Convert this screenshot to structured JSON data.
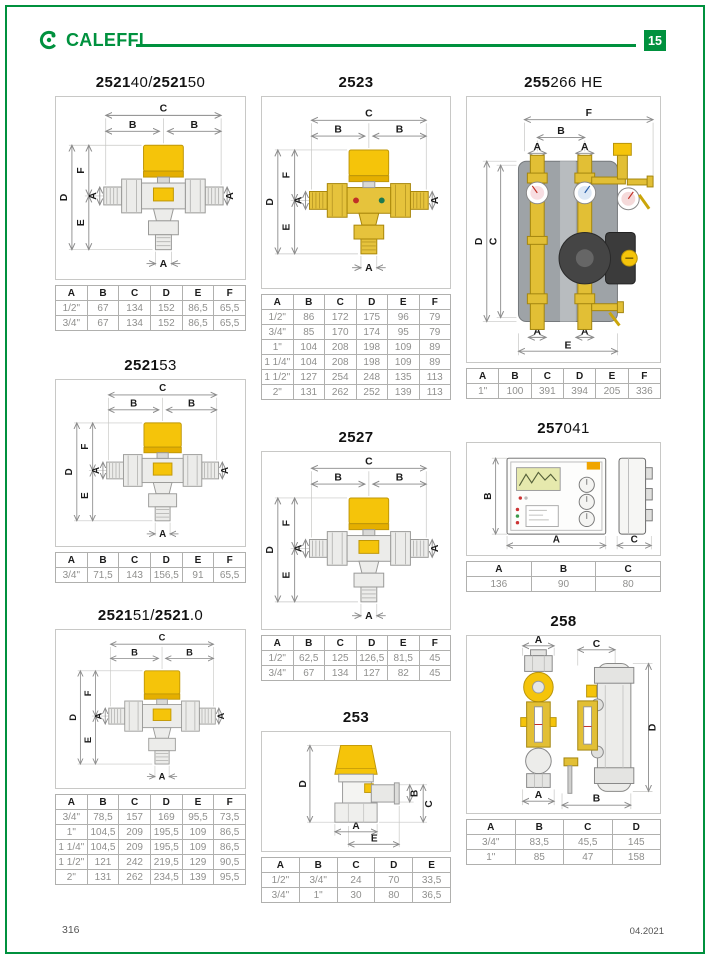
{
  "page": {
    "brand": "CALEFFI",
    "badge": "15",
    "footer_left": "316",
    "footer_right": "04.2021",
    "accent_green": "#00913e"
  },
  "dims": {
    "A": "A",
    "B": "B",
    "C": "C",
    "D": "D",
    "E": "E",
    "F": "F"
  },
  "sections": {
    "v252140": {
      "title": [
        {
          "t": "2521",
          "b": true
        },
        {
          "t": "40/",
          "b": false
        },
        {
          "t": "2521",
          "b": true
        },
        {
          "t": "50",
          "b": false
        }
      ],
      "table": {
        "headers": [
          "A",
          "B",
          "C",
          "D",
          "E",
          "F"
        ],
        "rows": [
          [
            "1/2\"",
            "67",
            "134",
            "152",
            "86,5",
            "65,5"
          ],
          [
            "3/4\"",
            "67",
            "134",
            "152",
            "86,5",
            "65,5"
          ]
        ]
      }
    },
    "v2523": {
      "title": [
        {
          "t": "2523",
          "b": true
        }
      ],
      "table": {
        "headers": [
          "A",
          "B",
          "C",
          "D",
          "E",
          "F"
        ],
        "rows": [
          [
            "1/2\"",
            "86",
            "172",
            "175",
            "96",
            "79"
          ],
          [
            "3/4\"",
            "85",
            "170",
            "174",
            "95",
            "79"
          ],
          [
            "1\"",
            "104",
            "208",
            "198",
            "109",
            "89"
          ],
          [
            "1 1/4\"",
            "104",
            "208",
            "198",
            "109",
            "89"
          ],
          [
            "1 1/2\"",
            "127",
            "254",
            "248",
            "135",
            "113"
          ],
          [
            "2\"",
            "131",
            "262",
            "252",
            "139",
            "113"
          ]
        ]
      }
    },
    "v255266": {
      "title": [
        {
          "t": "255",
          "b": true
        },
        {
          "t": "266 HE",
          "b": false
        }
      ],
      "table": {
        "headers": [
          "A",
          "B",
          "C",
          "D",
          "E",
          "F"
        ],
        "rows": [
          [
            "1\"",
            "100",
            "391",
            "394",
            "205",
            "336"
          ]
        ]
      }
    },
    "v252153": {
      "title": [
        {
          "t": "2521",
          "b": true
        },
        {
          "t": "53",
          "b": false
        }
      ],
      "table": {
        "headers": [
          "A",
          "B",
          "C",
          "D",
          "E",
          "F"
        ],
        "rows": [
          [
            "3/4\"",
            "71,5",
            "143",
            "156,5",
            "91",
            "65,5"
          ]
        ]
      }
    },
    "v2527": {
      "title": [
        {
          "t": "2527",
          "b": true
        }
      ],
      "table": {
        "headers": [
          "A",
          "B",
          "C",
          "D",
          "E",
          "F"
        ],
        "rows": [
          [
            "1/2\"",
            "62,5",
            "125",
            "126,5",
            "81,5",
            "45"
          ],
          [
            "3/4\"",
            "67",
            "134",
            "127",
            "82",
            "45"
          ]
        ]
      }
    },
    "v257041": {
      "title": [
        {
          "t": "257",
          "b": true
        },
        {
          "t": "041",
          "b": false
        }
      ],
      "table": {
        "headers": [
          "A",
          "B",
          "C"
        ],
        "rows": [
          [
            "136",
            "90",
            "80"
          ]
        ]
      }
    },
    "v252151": {
      "title": [
        {
          "t": "2521",
          "b": true
        },
        {
          "t": "51/",
          "b": false
        },
        {
          "t": "2521",
          "b": true
        },
        {
          "t": ".0",
          "b": false
        }
      ],
      "table": {
        "headers": [
          "A",
          "B",
          "C",
          "D",
          "E",
          "F"
        ],
        "rows": [
          [
            "3/4\"",
            "78,5",
            "157",
            "169",
            "95,5",
            "73,5"
          ],
          [
            "1\"",
            "104,5",
            "209",
            "195,5",
            "109",
            "86,5"
          ],
          [
            "1 1/4\"",
            "104,5",
            "209",
            "195,5",
            "109",
            "86,5"
          ],
          [
            "1 1/2\"",
            "121",
            "242",
            "219,5",
            "129",
            "90,5"
          ],
          [
            "2\"",
            "131",
            "262",
            "234,5",
            "139",
            "95,5"
          ]
        ]
      }
    },
    "v253": {
      "title": [
        {
          "t": "253",
          "b": true
        }
      ],
      "table": {
        "headers": [
          "A",
          "B",
          "C",
          "D",
          "E"
        ],
        "rows": [
          [
            "1/2\"",
            "3/4\"",
            "24",
            "70",
            "33,5"
          ],
          [
            "3/4\"",
            "1\"",
            "30",
            "80",
            "36,5"
          ]
        ]
      }
    },
    "v258": {
      "title": [
        {
          "t": "258",
          "b": true
        }
      ],
      "table": {
        "headers": [
          "A",
          "B",
          "C",
          "D"
        ],
        "rows": [
          [
            "3/4\"",
            "83,5",
            "45,5",
            "145"
          ],
          [
            "1\"",
            "85",
            "47",
            "158"
          ]
        ]
      }
    }
  }
}
